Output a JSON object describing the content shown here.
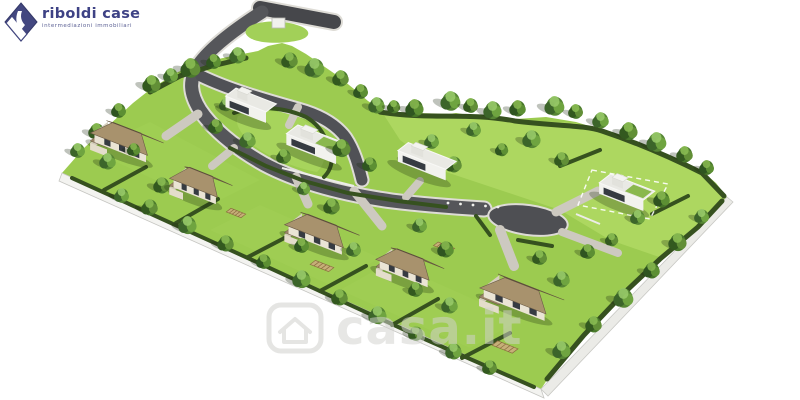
{
  "page": {
    "background": "#ffffff",
    "width": 800,
    "height": 400
  },
  "logo": {
    "brand": "riboldi case",
    "tagline": "intermediazioni immobiliari",
    "brand_color": "#3e4285",
    "icon": "diamond-ribbon-icon"
  },
  "watermark": {
    "text": "casa.it",
    "icon": "house-icon",
    "color": "#d2d2ce"
  },
  "palette": {
    "grass": "#9ccb50",
    "grass_light": "#b2da64",
    "asphalt": "#4e4f53",
    "curb": "#dedcd6",
    "driveway": "#cdc9c0",
    "hedge": "#36511f",
    "roof_front": "#a8926d",
    "roof_back": "#7d6a50",
    "house_wall": "#eae4d5",
    "modern_wall": "#f2f2ee",
    "glass": "#363b42",
    "green_roof": "#8ab84e",
    "wall_white": "#f3f3f0",
    "logo_navy": "#3e4285"
  },
  "scene": {
    "land": {
      "outline": "M62,173 L84,148 L108,126 L133,103 L152,88 L178,72 L205,62 L232,56 L258,51 L268,46 L282,43 L292,46 L306,54 L322,65 L338,76 L354,89 L368,101 L382,110 L402,116 L426,117 L456,113 L488,118 L516,119 L546,117 L576,122 L602,130 L628,140 L654,150 L680,159 L702,171 L716,183 L727,197 L716,212 L700,228 L682,244 L662,258 L644,276 L625,294 L606,314 L587,334 L567,356 L551,374 L541,389 L420,336 L240,256 L130,205 Z",
      "patches": [
        {
          "d": "M382,112 L456,114 L516,120 L576,123 L628,141 L680,160 L716,184 L727,197 L700,228 L662,258 L610,240 L560,210 L500,190 L440,170 L400,140 Z",
          "fill": "#b2da64",
          "op": 0.8
        },
        {
          "d": "M90,150 L210,205 L260,180 L150,122 Z",
          "fill": "#a6d258",
          "op": 0.4
        },
        {
          "d": "M210,230 L330,285 L380,258 L260,205 Z",
          "fill": "#a6d258",
          "op": 0.35
        },
        {
          "d": "M340,290 L470,348 L520,320 L390,262 Z",
          "fill": "#a6d258",
          "op": 0.35
        },
        {
          "d": "M238,116 C258,108 282,110 300,118 C313,124 320,134 324,148 C326,158 323,166 317,172 C295,168 268,157 252,144 C241,134 234,124 238,116 Z",
          "fill": "#a9d55d",
          "op": 0.9
        }
      ]
    },
    "walls": [
      {
        "d": "M62,173 L541,389 L544,398 L59,181 Z",
        "fill": "#f3f3f0",
        "stroke": "#c5c5c1"
      },
      {
        "d": "M541,389 L727,197 L733,202 L548,396 Z",
        "fill": "#ebebe7",
        "stroke": "#c8c8c4"
      }
    ],
    "roads": [
      {
        "d": "M260,8 L334,22",
        "w": 14,
        "c": "#46474b"
      },
      {
        "d": "M262,12 C240,26 212,46 199,64 C188,80 190,94 200,110 C212,128 234,147 264,164 C298,182 342,194 392,201 C424,205 452,207 484,209",
        "w": 13,
        "c": "#55565a"
      },
      {
        "d": "M201,76 C228,89 262,99 298,109 C320,115 336,124 346,138 C354,150 358,164 362,180",
        "w": 11,
        "c": "#505156"
      }
    ],
    "turnaround": {
      "cx": 528,
      "cy": 220,
      "rx": 40,
      "ry": 15,
      "rot": 8
    },
    "driveways": [
      {
        "d": "M198,114 L166,136",
        "w": 9
      },
      {
        "d": "M234,148 L212,166",
        "w": 8
      },
      {
        "d": "M296,177 L308,204",
        "w": 9
      },
      {
        "d": "M354,191 L382,226",
        "w": 9
      },
      {
        "d": "M500,230 L514,266",
        "w": 10
      },
      {
        "d": "M556,212 L598,191",
        "w": 9
      },
      {
        "d": "M562,232 L618,253",
        "w": 8
      },
      {
        "d": "M406,197 L420,181",
        "w": 8
      },
      {
        "d": "M298,107 L289,125",
        "w": 8
      }
    ],
    "terrace_lines": [
      {
        "d": "M282,168 L354,186"
      },
      {
        "d": "M576,214 L600,224"
      }
    ],
    "hedges": [
      {
        "d": "M150,92 L180,76 L212,66 L246,58",
        "w": 5
      },
      {
        "d": "M380,112 C430,120 468,112 515,121 C555,126 585,125 602,131 C632,141 662,153 702,173 L724,196",
        "w": 5
      },
      {
        "d": "M722,201 L698,227 L660,259 L622,295 L584,335 L547,379",
        "w": 5
      },
      {
        "d": "M72,178 L250,259 L420,337 L534,387",
        "w": 4
      },
      {
        "d": "M104,190 L146,167",
        "w": 4
      },
      {
        "d": "M176,223 L218,199",
        "w": 4
      },
      {
        "d": "M248,257 L294,233",
        "w": 4
      },
      {
        "d": "M320,291 L366,266",
        "w": 4
      },
      {
        "d": "M392,325 L438,299",
        "w": 4
      },
      {
        "d": "M462,358 L510,333",
        "w": 4
      },
      {
        "d": "M230,148 L266,166 L304,181 L348,193 L398,201 L446,207",
        "w": 4
      },
      {
        "d": "M234,113 C256,105 284,107 306,117 C320,125 326,137 331,153 C333,163 330,171 324,177",
        "w": 4
      },
      {
        "d": "M560,166 L600,150",
        "w": 4
      },
      {
        "d": "M652,214 L688,196",
        "w": 4
      },
      {
        "d": "M476,216 L490,235",
        "w": 4
      },
      {
        "d": "M518,240 L552,246",
        "w": 4
      }
    ],
    "lot_outline": "M592,170 L668,184 L650,219 L578,205 Z",
    "entrance_mound": "M250,26 C262,20 284,20 300,26 C310,30 312,36 300,40 C284,44 260,44 250,38 C244,34 244,30 250,26 Z",
    "cabinet": {
      "x": 272,
      "y": 18,
      "w": 13,
      "h": 10
    },
    "bollards": {
      "x1": 448,
      "y1": 203,
      "x2": 498,
      "y2": 207,
      "n": 5
    },
    "houses": [
      {
        "id": "villa-1",
        "type": "pitched",
        "x": 127,
        "y": 147,
        "w": 56,
        "d": 26,
        "wing": true
      },
      {
        "id": "villa-2",
        "type": "pitched",
        "x": 201,
        "y": 191,
        "w": 46,
        "d": 24,
        "wing": true
      },
      {
        "id": "villa-3",
        "type": "pitched",
        "x": 322,
        "y": 239,
        "w": 58,
        "d": 26,
        "wing": true
      },
      {
        "id": "villa-4",
        "type": "pitched",
        "x": 410,
        "y": 273,
        "w": 52,
        "d": 24,
        "wing": true
      },
      {
        "id": "villa-5",
        "type": "pitched",
        "x": 522,
        "y": 303,
        "w": 66,
        "d": 30,
        "wing": true
      },
      {
        "id": "modern-1",
        "type": "modern",
        "x": 251,
        "y": 111,
        "w": 44,
        "d": 20,
        "green": false
      },
      {
        "id": "modern-2",
        "type": "modern",
        "x": 317,
        "y": 150,
        "w": 54,
        "d": 22,
        "green": true
      },
      {
        "id": "modern-3",
        "type": "modern",
        "x": 427,
        "y": 167,
        "w": 52,
        "d": 20,
        "green": false
      },
      {
        "id": "modern-4",
        "type": "modern",
        "x": 627,
        "y": 198,
        "w": 48,
        "d": 22,
        "green": true
      }
    ],
    "pergolas": [
      {
        "x": 236,
        "y": 213,
        "w": 16,
        "d": 9
      },
      {
        "x": 322,
        "y": 266,
        "w": 20,
        "d": 10
      },
      {
        "x": 444,
        "y": 247,
        "w": 18,
        "d": 9
      },
      {
        "x": 505,
        "y": 347,
        "w": 22,
        "d": 11
      }
    ],
    "trees": [
      [
        152,
        86,
        11,
        0
      ],
      [
        171,
        77,
        9,
        1
      ],
      [
        191,
        70,
        12,
        0
      ],
      [
        214,
        63,
        9,
        2
      ],
      [
        238,
        57,
        10,
        1
      ],
      [
        290,
        62,
        10,
        0
      ],
      [
        315,
        70,
        12,
        1
      ],
      [
        341,
        80,
        10,
        0
      ],
      [
        361,
        93,
        9,
        2
      ],
      [
        377,
        107,
        10,
        1
      ],
      [
        394,
        108,
        8,
        0
      ],
      [
        415,
        110,
        11,
        2
      ],
      [
        451,
        103,
        12,
        1
      ],
      [
        471,
        107,
        9,
        0
      ],
      [
        493,
        112,
        11,
        1
      ],
      [
        518,
        110,
        10,
        2
      ],
      [
        555,
        108,
        12,
        1
      ],
      [
        576,
        113,
        9,
        0
      ],
      [
        601,
        122,
        10,
        1
      ],
      [
        629,
        133,
        11,
        0
      ],
      [
        657,
        144,
        12,
        1
      ],
      [
        685,
        156,
        10,
        0
      ],
      [
        707,
        169,
        9,
        2
      ],
      [
        78,
        152,
        9,
        1
      ],
      [
        97,
        133,
        10,
        0
      ],
      [
        119,
        112,
        9,
        2
      ],
      [
        108,
        163,
        10,
        1
      ],
      [
        134,
        151,
        8,
        2
      ],
      [
        162,
        187,
        10,
        0
      ],
      [
        122,
        197,
        9,
        1
      ],
      [
        150,
        209,
        10,
        0
      ],
      [
        188,
        227,
        11,
        1
      ],
      [
        226,
        245,
        10,
        0
      ],
      [
        264,
        263,
        9,
        2
      ],
      [
        302,
        281,
        11,
        1
      ],
      [
        340,
        299,
        10,
        0
      ],
      [
        378,
        317,
        11,
        1
      ],
      [
        416,
        335,
        9,
        0
      ],
      [
        454,
        353,
        10,
        1
      ],
      [
        490,
        369,
        9,
        0
      ],
      [
        562,
        352,
        11,
        1
      ],
      [
        594,
        326,
        10,
        0
      ],
      [
        624,
        300,
        12,
        1
      ],
      [
        652,
        272,
        10,
        2
      ],
      [
        678,
        244,
        11,
        0
      ],
      [
        702,
        218,
        9,
        1
      ],
      [
        216,
        128,
        9,
        2
      ],
      [
        248,
        142,
        10,
        1
      ],
      [
        284,
        158,
        9,
        0
      ],
      [
        226,
        106,
        8,
        1
      ],
      [
        342,
        150,
        11,
        0
      ],
      [
        370,
        166,
        9,
        2
      ],
      [
        304,
        190,
        8,
        1
      ],
      [
        332,
        208,
        10,
        0
      ],
      [
        302,
        247,
        9,
        2
      ],
      [
        354,
        251,
        9,
        1
      ],
      [
        412,
        160,
        10,
        2
      ],
      [
        432,
        143,
        9,
        1
      ],
      [
        454,
        166,
        10,
        0
      ],
      [
        420,
        227,
        9,
        1
      ],
      [
        446,
        251,
        10,
        2
      ],
      [
        416,
        291,
        9,
        0
      ],
      [
        450,
        307,
        10,
        1
      ],
      [
        496,
        289,
        9,
        2
      ],
      [
        540,
        259,
        9,
        0
      ],
      [
        562,
        281,
        10,
        1
      ],
      [
        588,
        253,
        9,
        2
      ],
      [
        612,
        241,
        8,
        0
      ],
      [
        638,
        219,
        9,
        1
      ],
      [
        662,
        201,
        10,
        2
      ],
      [
        562,
        161,
        9,
        0
      ],
      [
        532,
        141,
        11,
        1
      ],
      [
        502,
        151,
        8,
        2
      ],
      [
        474,
        131,
        9,
        1
      ]
    ]
  }
}
